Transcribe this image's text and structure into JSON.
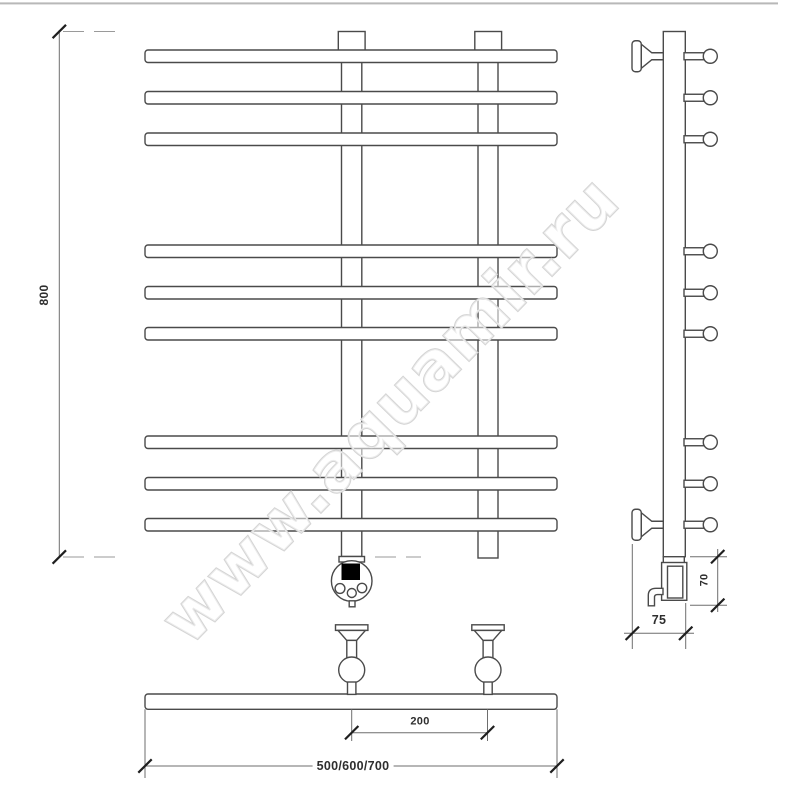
{
  "canvas": {
    "width": 800,
    "height": 800,
    "background": "#ffffff",
    "top_edge_color": "#b8b8b8"
  },
  "watermark": {
    "text": "www.aquamir.ru"
  },
  "labels": {
    "overall_height": "800",
    "bracket_spacing": "200",
    "width_options": "500/600/700",
    "wall_depth": "75",
    "heater_height": "70"
  },
  "views": {
    "front": {
      "title": "front-view",
      "towel_bar_count": 9,
      "post_count": 2,
      "has_thermostat_head": true
    },
    "side": {
      "title": "side-view",
      "hook_count": 9,
      "wall_bracket_count": 2,
      "has_heating_element_box": true
    },
    "plan": {
      "title": "plan-view",
      "wall_bracket_count": 2
    }
  },
  "colors": {
    "outline": "#4a4a4a",
    "dimension_line": "#6e6e6e",
    "tick": "#1f1f1f",
    "label_text": "#2e2e2e",
    "dashed_extension": "#9a9a9a",
    "watermark_stroke": "#d4d4d4",
    "display_fill": "#000000"
  }
}
